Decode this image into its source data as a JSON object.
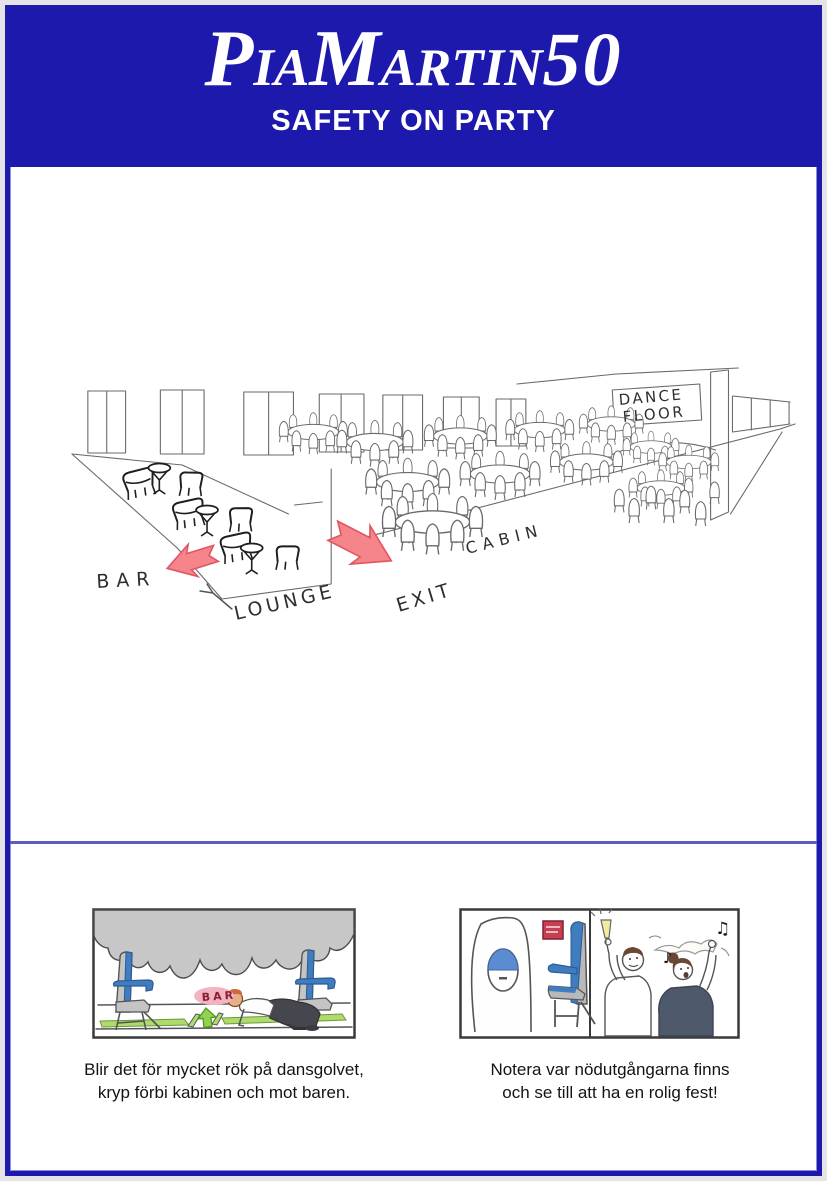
{
  "header": {
    "logo": {
      "part1": "P",
      "part2": "IA",
      "part3": "M",
      "part4": "ARTIN",
      "part5": "50"
    },
    "subtitle": "SAFETY ON PARTY"
  },
  "floorplan": {
    "labels": {
      "bar": "BAR",
      "lounge": "LOUNGE",
      "exit": "EXIT",
      "cabin": "CABIN",
      "dance_line1": "DANCE",
      "dance_line2": "FLOOR"
    }
  },
  "panels": {
    "left": {
      "sign_label": "BAR",
      "caption": {
        "line1": "Blir det för mycket rök på dansgolvet,",
        "line2": "kryp förbi kabinen och mot baren."
      }
    },
    "right": {
      "icons": {
        "music_note": "♪",
        "music_notes": "♫"
      },
      "caption": {
        "line1": "Notera var nödutgångarna finns",
        "line2": "och se till att ha en rolig fest!"
      }
    }
  },
  "colors": {
    "frame_blue": "#1e19ad",
    "divider_blue": "#5e5bc2",
    "arrow_red": "#f5848b",
    "arrow_green": "#90d44e",
    "seat_blue": "#3f7dc0",
    "smoke_gray": "#c7c7c7",
    "bar_sign_pink": "#f3b3c2",
    "exit_sign_red": "#c64052",
    "floor_strip_green": "#aeda6e"
  }
}
